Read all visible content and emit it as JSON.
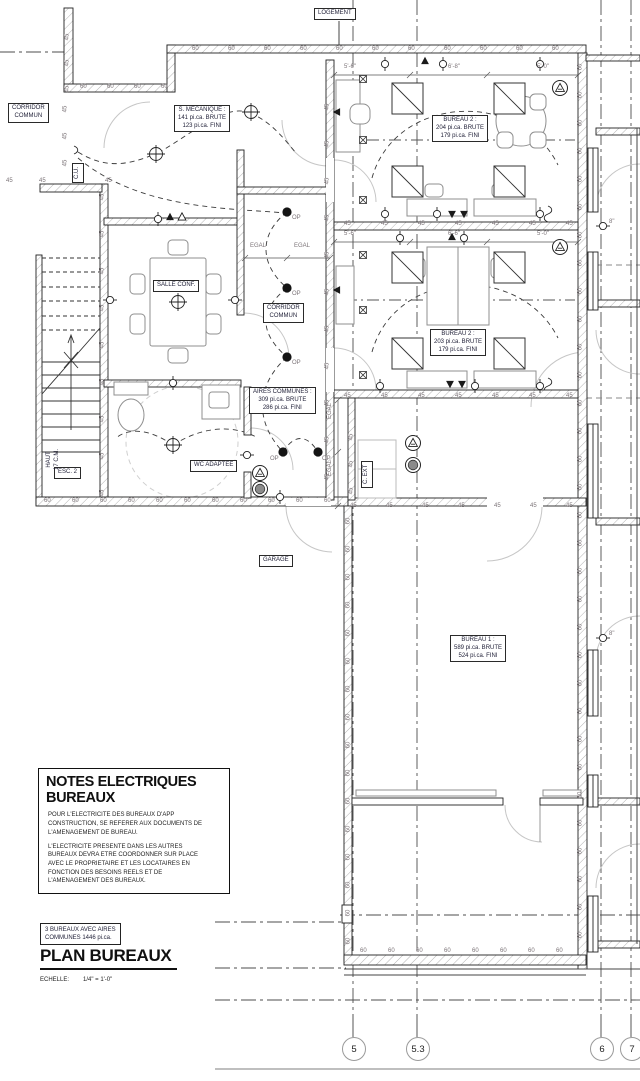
{
  "labels": {
    "logement": "LOGEMENT",
    "corridor_commun": [
      "CORRIDOR",
      "COMMUN"
    ],
    "corridor_commun_mid": [
      "CORRIDOR",
      "COMMUN"
    ],
    "salle_conf": "SALLE CONF.",
    "wc_adaptee": "WC ADAPTEE",
    "garage": "GARAGE",
    "esc2": "ESC. 2",
    "haut": [
      "HAUT",
      "17 C.M."
    ],
    "cu": "C.U.",
    "cext": "C. EXT"
  },
  "rooms": {
    "s_mecanique": {
      "name": "S. MECANIQUE :",
      "brute": "141 pi.ca. BRUTE",
      "fini": "123 pi.ca. FINI"
    },
    "bureau2_a": {
      "name": "BUREAU 2 :",
      "brute": "204 pi.ca. BRUTE",
      "fini": "179 pi.ca. FINI"
    },
    "bureau2_b": {
      "name": "BUREAU 2 :",
      "brute": "203 pi.ca. BRUTE",
      "fini": "179 pi.ca. FINI"
    },
    "bureau1": {
      "name": "BUREAU 1 :",
      "brute": "589 pi.ca. BRUTE",
      "fini": "524 pi.ca. FINI"
    },
    "aires_communes": {
      "name": "AIRES COMMUNES :",
      "brute": "309 pi.ca. BRUTE",
      "fini": "286 pi.ca. FINI"
    }
  },
  "notes": {
    "title_line1": "NOTES ELECTRIQUES",
    "title_line2": "BUREAUX",
    "para1": "POUR L'ELECTRICITE DES BUREAUX D'APP CONSTRUCTION, SE REFERER AUX DOCUMENTS DE L'AMENAGEMENT DE BUREAU.",
    "para2": "L'ELECTRICITE PRESENTE DANS LES AUTRES BUREAUX DEVRA ETRE COORDONNER SUR PLACE AVEC LE PROPRIETAIRE ET LES LOCATAIRES EN FONCTION DES BESOINS REELS ET DE L'AMENAGEMENT DES BUREAUX."
  },
  "titleblock": {
    "summary_line1": "3 BUREAUX AVEC AIRES",
    "summary_line2": "COMMUNES 1446 pi.ca.",
    "plan_title": "PLAN BUREAUX",
    "echelle_label": "ECHELLE:",
    "echelle_value": "1/4\" = 1'-0\""
  },
  "grid": {
    "labels": [
      "5",
      "5.3",
      "6",
      "7"
    ],
    "x": [
      353,
      417,
      601,
      631
    ],
    "y": 1048
  },
  "dims": {
    "runs": [
      {
        "v": "60",
        "x": 192,
        "y": 46,
        "dx": 36,
        "dy": 0,
        "n": 11,
        "rot": 0
      },
      {
        "v": "60",
        "x": 80,
        "y": 84,
        "dx": 27,
        "dy": 0,
        "n": 4,
        "rot": 0
      },
      {
        "v": "45",
        "x": 64,
        "y": 34,
        "dx": 0,
        "dy": 26,
        "n": 3,
        "rot": 1
      },
      {
        "v": "45",
        "x": 62,
        "y": 106,
        "dx": 0,
        "dy": 27,
        "n": 3,
        "rot": 1
      },
      {
        "v": "45",
        "x": 6,
        "y": 178,
        "dx": 33,
        "dy": 0,
        "n": 4,
        "rot": 0
      },
      {
        "v": "45",
        "x": 99,
        "y": 194,
        "dx": 0,
        "dy": 37,
        "n": 9,
        "rot": 1
      },
      {
        "v": "45",
        "x": 324,
        "y": 104,
        "dx": 0,
        "dy": 37,
        "n": 11,
        "rot": 1
      },
      {
        "v": "45",
        "x": 344,
        "y": 221,
        "dx": 37,
        "dy": 0,
        "n": 7,
        "rot": 0
      },
      {
        "v": "45",
        "x": 344,
        "y": 393,
        "dx": 37,
        "dy": 0,
        "n": 7,
        "rot": 0
      },
      {
        "v": "60",
        "x": 44,
        "y": 498,
        "dx": 28,
        "dy": 0,
        "n": 11,
        "rot": 0
      },
      {
        "v": "45",
        "x": 350,
        "y": 503,
        "dx": 36,
        "dy": 0,
        "n": 7,
        "rot": 0
      },
      {
        "v": "45",
        "x": 348,
        "y": 434,
        "dx": 0,
        "dy": 27,
        "n": 3,
        "rot": 1
      },
      {
        "v": "60",
        "x": 345,
        "y": 518,
        "dx": 0,
        "dy": 28,
        "n": 16,
        "rot": 1
      },
      {
        "v": "60",
        "x": 577,
        "y": 64,
        "dx": 0,
        "dy": 28,
        "n": 32,
        "rot": 1
      },
      {
        "v": "60",
        "x": 360,
        "y": 948,
        "dx": 28,
        "dy": 0,
        "n": 8,
        "rot": 0
      }
    ],
    "texts": [
      {
        "t": "5'-6\"",
        "x": 344,
        "y": 64,
        "rot": 0
      },
      {
        "t": "6'-8\"",
        "x": 448,
        "y": 64,
        "rot": 0
      },
      {
        "t": "5'-0\"",
        "x": 537,
        "y": 64,
        "rot": 0
      },
      {
        "t": "5'-6\"",
        "x": 344,
        "y": 231,
        "rot": 0
      },
      {
        "t": "6'-6\"",
        "x": 448,
        "y": 231,
        "rot": 0
      },
      {
        "t": "5'-0\"",
        "x": 537,
        "y": 231,
        "rot": 0
      },
      {
        "t": "8\"",
        "x": 609,
        "y": 219,
        "rot": 0
      },
      {
        "t": "8\"",
        "x": 609,
        "y": 631,
        "rot": 0
      },
      {
        "t": "EGAL",
        "x": 250,
        "y": 243,
        "rot": 0
      },
      {
        "t": "EGAL",
        "x": 294,
        "y": 243,
        "rot": 0
      },
      {
        "t": "EGAL",
        "x": 322,
        "y": 408,
        "rot": 1
      },
      {
        "t": "EGAL",
        "x": 322,
        "y": 465,
        "rot": 1
      },
      {
        "t": "OP",
        "x": 292,
        "y": 215,
        "rot": 0
      },
      {
        "t": "OP",
        "x": 292,
        "y": 291,
        "rot": 0
      },
      {
        "t": "OP",
        "x": 292,
        "y": 360,
        "rot": 0
      },
      {
        "t": "OP",
        "x": 270,
        "y": 456,
        "rot": 0
      },
      {
        "t": "OP",
        "x": 322,
        "y": 456,
        "rot": 0
      }
    ]
  },
  "icons": {
    "recessed_light": "square-with-diagonal",
    "ceiling_light": "circle-with-cross-ticks",
    "wall_sconce": "phi-circle-on-wall",
    "ceiling_outlet_op": "filled-dot-OP",
    "data_outlet": "boxed-x",
    "thermostat_a": "circled-triangle-A",
    "junction_dark": "circled-dark-dot"
  },
  "colors": {
    "wall_line": "#222222",
    "dim_text": "#7c7478",
    "label_text": "#23233a",
    "door_arc": "#c6c6c6",
    "grid_line": "#4d4d4d"
  }
}
